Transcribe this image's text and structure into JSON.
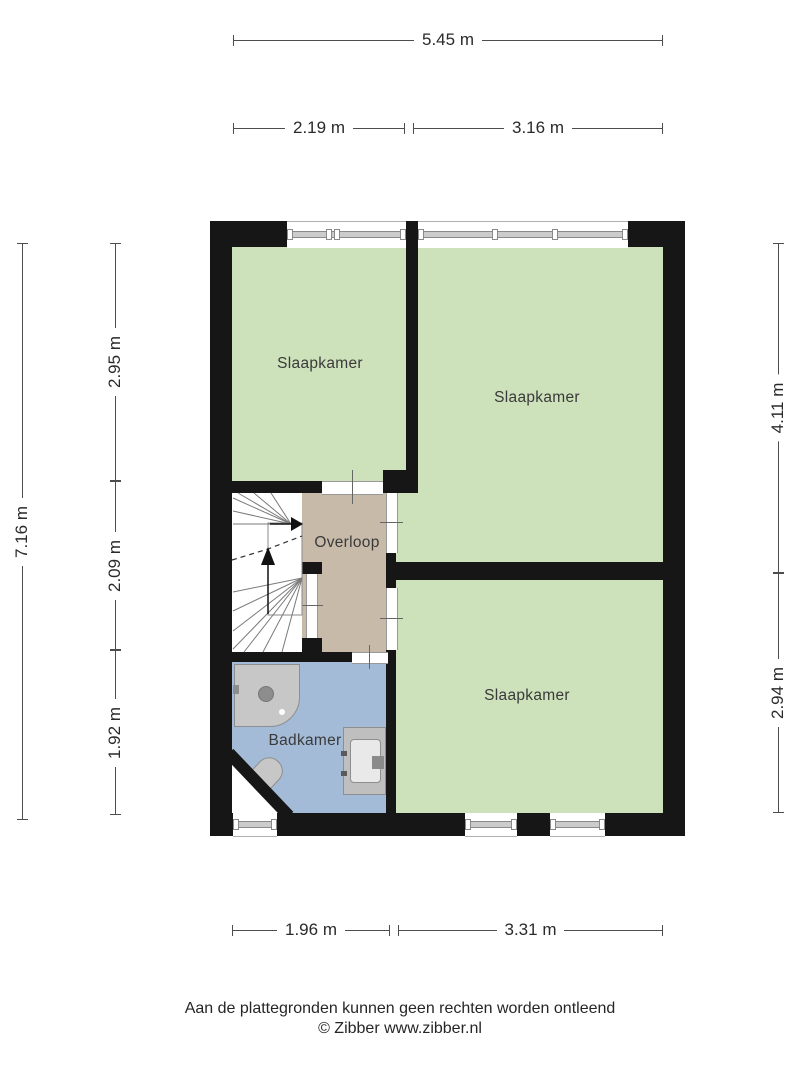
{
  "title": "Floor plan first floor (plattegrond verdieping)",
  "rooms": {
    "bedroom_top_left": "Slaapkamer",
    "bedroom_top_right": "Slaapkamer",
    "bedroom_bottom_right": "Slaapkamer",
    "landing": "Overloop",
    "bathroom": "Badkamer"
  },
  "dimensions": {
    "top_total": "5.45 m",
    "top_segments": [
      "2.19 m",
      "3.16 m"
    ],
    "left_total": "7.16 m",
    "left_segments": [
      "2.95 m",
      "2.09 m",
      "1.92 m"
    ],
    "right_segments": [
      "4.11 m",
      "2.94 m"
    ],
    "bottom_segments": [
      "1.96 m",
      "3.31 m"
    ]
  },
  "footer": {
    "disclaimer": "Aan de plattegronden kunnen geen rechten worden ontleend",
    "credit": "© Zibber www.zibber.nl"
  },
  "colors": {
    "room_green": "#cde1ba",
    "landing_tan": "#c8baa9",
    "bathroom_blue": "#a4bbd8",
    "wall": "#161616",
    "background": "#ffffff"
  }
}
